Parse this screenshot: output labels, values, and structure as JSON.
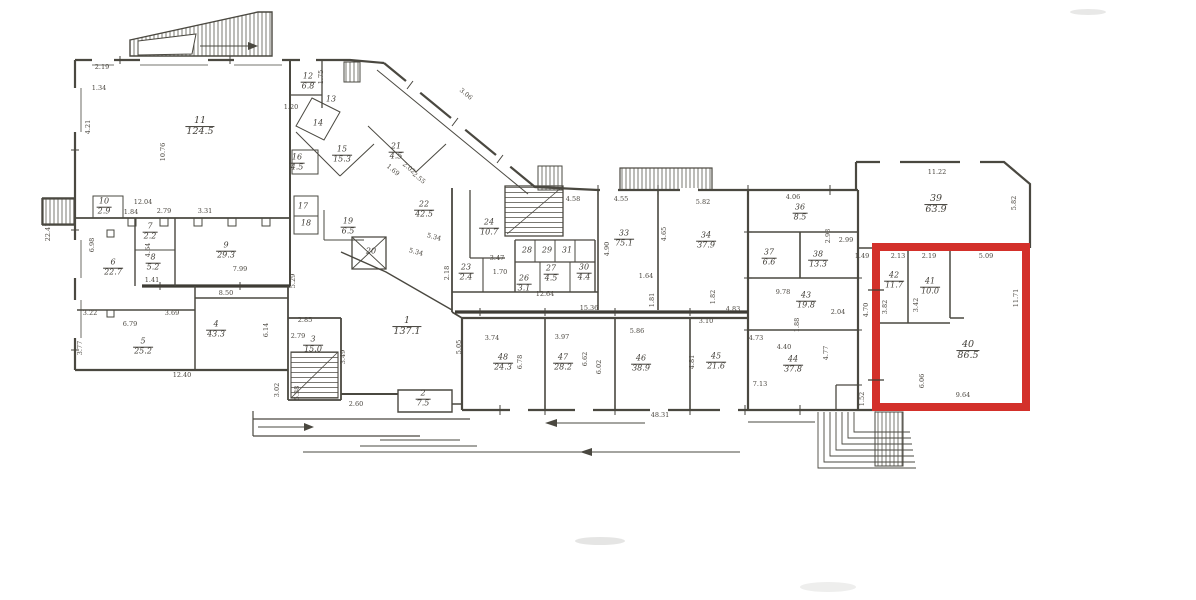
{
  "highlight": {
    "color": "#d3302a"
  },
  "line_color": "#4a4840",
  "plan": {
    "rooms": [
      {
        "no": "1",
        "area": "137.1",
        "x": 407,
        "y": 327,
        "s": 2
      },
      {
        "no": "2",
        "area": "7.5",
        "x": 423,
        "y": 399
      },
      {
        "no": "3",
        "area": "15.0",
        "x": 313,
        "y": 345
      },
      {
        "no": "4",
        "area": "43.3",
        "x": 216,
        "y": 330
      },
      {
        "no": "5",
        "area": "25.2",
        "x": 143,
        "y": 347
      },
      {
        "no": "6",
        "area": "22.7",
        "x": 113,
        "y": 268
      },
      {
        "no": "7",
        "area": "2.2",
        "x": 150,
        "y": 232
      },
      {
        "no": "8",
        "area": "5.2",
        "x": 153,
        "y": 263
      },
      {
        "no": "9",
        "area": "29.3",
        "x": 226,
        "y": 251
      },
      {
        "no": "10",
        "area": "2.9",
        "x": 104,
        "y": 207
      },
      {
        "no": "11",
        "area": "124.5",
        "x": 200,
        "y": 127,
        "s": 2
      },
      {
        "no": "12",
        "area": "6.8",
        "x": 308,
        "y": 82
      },
      {
        "no": "13",
        "x": 331,
        "y": 100
      },
      {
        "no": "14",
        "x": 318,
        "y": 124
      },
      {
        "no": "15",
        "area": "15.3",
        "x": 342,
        "y": 155
      },
      {
        "no": "16",
        "area": "4.5",
        "x": 297,
        "y": 163
      },
      {
        "no": "17",
        "x": 303,
        "y": 207
      },
      {
        "no": "18",
        "x": 306,
        "y": 224
      },
      {
        "no": "19",
        "area": "6.5",
        "x": 348,
        "y": 227
      },
      {
        "no": "20",
        "x": 371,
        "y": 252
      },
      {
        "no": "21",
        "area": "4.5",
        "x": 396,
        "y": 152
      },
      {
        "no": "22",
        "area": "42.5",
        "x": 424,
        "y": 210
      },
      {
        "no": "23",
        "area": "2.4",
        "x": 466,
        "y": 273
      },
      {
        "no": "24",
        "area": "10.7",
        "x": 489,
        "y": 228
      },
      {
        "no": "26",
        "area": "3.1",
        "x": 524,
        "y": 284
      },
      {
        "no": "27",
        "area": "4.5",
        "x": 551,
        "y": 274
      },
      {
        "no": "28",
        "x": 527,
        "y": 251
      },
      {
        "no": "29",
        "x": 547,
        "y": 251
      },
      {
        "no": "31",
        "x": 567,
        "y": 251
      },
      {
        "no": "30",
        "area": "4.4",
        "x": 584,
        "y": 273
      },
      {
        "no": "33",
        "area": "75.1",
        "x": 624,
        "y": 239
      },
      {
        "no": "34",
        "area": "37.9",
        "x": 706,
        "y": 241
      },
      {
        "no": "36",
        "area": "8.5",
        "x": 800,
        "y": 213
      },
      {
        "no": "37",
        "area": "6.6",
        "x": 769,
        "y": 258
      },
      {
        "no": "38",
        "area": "13.3",
        "x": 818,
        "y": 260
      },
      {
        "no": "39",
        "area": "63.9",
        "x": 936,
        "y": 205,
        "s": 2
      },
      {
        "no": "40",
        "area": "86.5",
        "x": 968,
        "y": 351,
        "s": 2
      },
      {
        "no": "41",
        "area": "10.0",
        "x": 930,
        "y": 287
      },
      {
        "no": "42",
        "area": "11.7",
        "x": 894,
        "y": 281
      },
      {
        "no": "43",
        "area": "19.8",
        "x": 806,
        "y": 301
      },
      {
        "no": "44",
        "area": "37.8",
        "x": 793,
        "y": 365
      },
      {
        "no": "45",
        "area": "21.6",
        "x": 716,
        "y": 362
      },
      {
        "no": "46",
        "area": "38.9",
        "x": 641,
        "y": 364
      },
      {
        "no": "47",
        "area": "28.2",
        "x": 563,
        "y": 363
      },
      {
        "no": "48",
        "area": "24.3",
        "x": 503,
        "y": 363
      }
    ],
    "dims": [
      {
        "t": "2.19",
        "x": 102,
        "y": 67
      },
      {
        "t": "1.34",
        "x": 99,
        "y": 88
      },
      {
        "t": "4.21",
        "x": 88,
        "y": 127,
        "r": -90
      },
      {
        "t": "10.76",
        "x": 163,
        "y": 152,
        "r": -90
      },
      {
        "t": "12.04",
        "x": 143,
        "y": 202
      },
      {
        "t": "22.41",
        "x": 48,
        "y": 232,
        "r": -90
      },
      {
        "t": "1.84",
        "x": 131,
        "y": 212
      },
      {
        "t": "2.79",
        "x": 164,
        "y": 211
      },
      {
        "t": "3.31",
        "x": 205,
        "y": 211
      },
      {
        "t": "1.75",
        "x": 321,
        "y": 77,
        "r": -90
      },
      {
        "t": "1.20",
        "x": 291,
        "y": 107
      },
      {
        "t": "6.98",
        "x": 92,
        "y": 245,
        "r": -90
      },
      {
        "t": "4.64",
        "x": 148,
        "y": 250,
        "r": -90
      },
      {
        "t": "1.41",
        "x": 152,
        "y": 280
      },
      {
        "t": "7.99",
        "x": 240,
        "y": 269
      },
      {
        "t": "8.50",
        "x": 226,
        "y": 293
      },
      {
        "t": "3.22",
        "x": 90,
        "y": 313
      },
      {
        "t": "3.69",
        "x": 172,
        "y": 313
      },
      {
        "t": "6.79",
        "x": 130,
        "y": 324
      },
      {
        "t": "3.77",
        "x": 80,
        "y": 348,
        "r": -90
      },
      {
        "t": "6.14",
        "x": 266,
        "y": 330,
        "r": -90
      },
      {
        "t": "5.29",
        "x": 293,
        "y": 281,
        "r": -90
      },
      {
        "t": "12.40",
        "x": 182,
        "y": 375
      },
      {
        "t": "2.85",
        "x": 305,
        "y": 320
      },
      {
        "t": "2.79",
        "x": 298,
        "y": 336
      },
      {
        "t": "3.49",
        "x": 343,
        "y": 357,
        "r": -90
      },
      {
        "t": "3.02",
        "x": 277,
        "y": 390,
        "r": -90
      },
      {
        "t": "5.38",
        "x": 297,
        "y": 393,
        "r": -90
      },
      {
        "t": "2.60",
        "x": 356,
        "y": 404
      },
      {
        "t": "1.69",
        "x": 393,
        "y": 170,
        "r": 40
      },
      {
        "t": "2.02",
        "x": 409,
        "y": 168,
        "r": 40
      },
      {
        "t": "2.55",
        "x": 419,
        "y": 178,
        "r": 40
      },
      {
        "t": "3.06",
        "x": 466,
        "y": 94,
        "r": 40
      },
      {
        "t": "5.34",
        "x": 434,
        "y": 237,
        "r": 15
      },
      {
        "t": "5.34",
        "x": 416,
        "y": 252,
        "r": 15
      },
      {
        "t": "2.18",
        "x": 447,
        "y": 273,
        "r": -90
      },
      {
        "t": "3.47",
        "x": 497,
        "y": 258
      },
      {
        "t": "1.70",
        "x": 500,
        "y": 272
      },
      {
        "t": "12.64",
        "x": 545,
        "y": 294
      },
      {
        "t": "15.36",
        "x": 589,
        "y": 308
      },
      {
        "t": "4.90",
        "x": 607,
        "y": 249,
        "r": -90
      },
      {
        "t": "4.58",
        "x": 573,
        "y": 199
      },
      {
        "t": "4.55",
        "x": 621,
        "y": 199
      },
      {
        "t": "5.82",
        "x": 703,
        "y": 202
      },
      {
        "t": "4.65",
        "x": 664,
        "y": 234,
        "r": -90
      },
      {
        "t": "1.64",
        "x": 646,
        "y": 276
      },
      {
        "t": "1.81",
        "x": 652,
        "y": 300,
        "r": -90
      },
      {
        "t": "1.82",
        "x": 713,
        "y": 297,
        "r": -90
      },
      {
        "t": "4.06",
        "x": 793,
        "y": 197
      },
      {
        "t": "2.93",
        "x": 828,
        "y": 236,
        "r": -90
      },
      {
        "t": "2.99",
        "x": 846,
        "y": 240
      },
      {
        "t": "9.78",
        "x": 783,
        "y": 292
      },
      {
        "t": "2.04",
        "x": 838,
        "y": 312
      },
      {
        "t": "1.88",
        "x": 797,
        "y": 325,
        "r": -90
      },
      {
        "t": "4.83",
        "x": 733,
        "y": 309
      },
      {
        "t": "3.10",
        "x": 706,
        "y": 321
      },
      {
        "t": "4.73",
        "x": 756,
        "y": 338
      },
      {
        "t": "4.40",
        "x": 784,
        "y": 347
      },
      {
        "t": "7.13",
        "x": 760,
        "y": 384
      },
      {
        "t": "4.77",
        "x": 826,
        "y": 353,
        "r": -90
      },
      {
        "t": "5.05",
        "x": 459,
        "y": 347,
        "r": -90
      },
      {
        "t": "3.74",
        "x": 492,
        "y": 338
      },
      {
        "t": "3.97",
        "x": 562,
        "y": 337
      },
      {
        "t": "5.86",
        "x": 637,
        "y": 331
      },
      {
        "t": "6.78",
        "x": 520,
        "y": 362,
        "r": -90
      },
      {
        "t": "6.62",
        "x": 585,
        "y": 359,
        "r": -90
      },
      {
        "t": "6.02",
        "x": 599,
        "y": 367,
        "r": -90
      },
      {
        "t": "4.81",
        "x": 692,
        "y": 362,
        "r": -90
      },
      {
        "t": "48.31",
        "x": 660,
        "y": 415
      },
      {
        "t": "1.49",
        "x": 862,
        "y": 256
      },
      {
        "t": "11.22",
        "x": 937,
        "y": 172
      },
      {
        "t": "5.82",
        "x": 1014,
        "y": 203,
        "r": -90
      },
      {
        "t": "2.13",
        "x": 898,
        "y": 256
      },
      {
        "t": "2.19",
        "x": 929,
        "y": 256
      },
      {
        "t": "5.09",
        "x": 986,
        "y": 256
      },
      {
        "t": "3.82",
        "x": 885,
        "y": 307,
        "r": -90
      },
      {
        "t": "3.42",
        "x": 916,
        "y": 305,
        "r": -90
      },
      {
        "t": "11.71",
        "x": 1016,
        "y": 298,
        "r": -90
      },
      {
        "t": "4.70",
        "x": 866,
        "y": 310,
        "r": -90
      },
      {
        "t": "6.06",
        "x": 922,
        "y": 381,
        "r": -90
      },
      {
        "t": "9.64",
        "x": 963,
        "y": 395
      },
      {
        "t": "1.52",
        "x": 862,
        "y": 399,
        "r": -90
      }
    ]
  }
}
